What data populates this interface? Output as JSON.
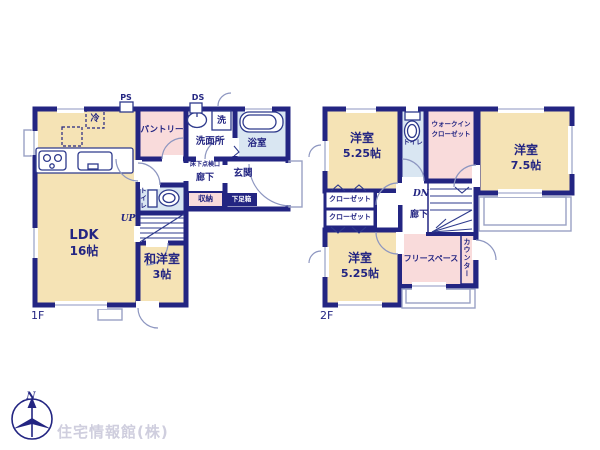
{
  "floor1": {
    "floor_label": "1F",
    "pipe_space": "PS",
    "duct_space": "DS",
    "fridge": "冷",
    "pantry": "パントリー",
    "laundry": "洗",
    "washroom": "洗面所",
    "bath": "浴室",
    "underfloor_hatch": "床下点検口",
    "hall": "廊下",
    "entrance": "玄関",
    "storage": "収納",
    "shoe_box": "下足箱",
    "toilet": "トイレ",
    "stairs_up": "UP",
    "ldk": {
      "name": "LDK",
      "size": "16帖"
    },
    "wayoshitsu": {
      "name": "和洋室",
      "size": "3帖"
    }
  },
  "floor2": {
    "floor_label": "2F",
    "bedroom_nw": {
      "name": "洋室",
      "size": "5.25帖"
    },
    "bedroom_e": {
      "name": "洋室",
      "size": "7.5帖"
    },
    "bedroom_sw": {
      "name": "洋室",
      "size": "5.25帖"
    },
    "toilet": "トイレ",
    "walk_in_closet": {
      "line1": "ウォークイン",
      "line2": "クローゼット"
    },
    "closet1": "クローゼット",
    "closet2": "クローゼット",
    "stairs_down": "DN",
    "hall": "廊下",
    "free_space": "フリースペース",
    "counter": "カウンター"
  },
  "branding": {
    "compass_north": "N",
    "watermark": "住宅情報館(株)"
  },
  "colors": {
    "wall": "#232582",
    "room_tan": "#f5e3b5",
    "room_pink": "#f9dbdb",
    "room_blue": "#d9e6f2",
    "thin_line": "#99a1c4",
    "watermark_gray": "#cfcede"
  }
}
